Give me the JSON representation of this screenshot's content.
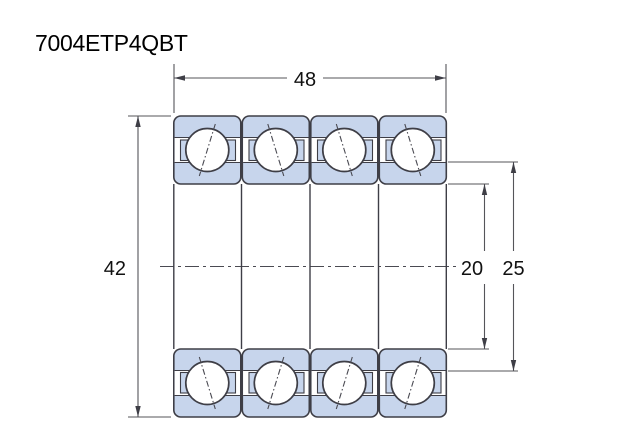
{
  "title": "7004ETP4QBT",
  "dimensions": {
    "width": "48",
    "outside_diameter": "42",
    "bore_diameter": "20",
    "inner_shoulder_diameter": "25"
  },
  "colors": {
    "ring_fill": "#c7d5ec",
    "outline": "#3e3e46",
    "dimension_line": "#55555a",
    "background": "#ffffff"
  },
  "bearings": {
    "count": 4,
    "rows": 2
  }
}
